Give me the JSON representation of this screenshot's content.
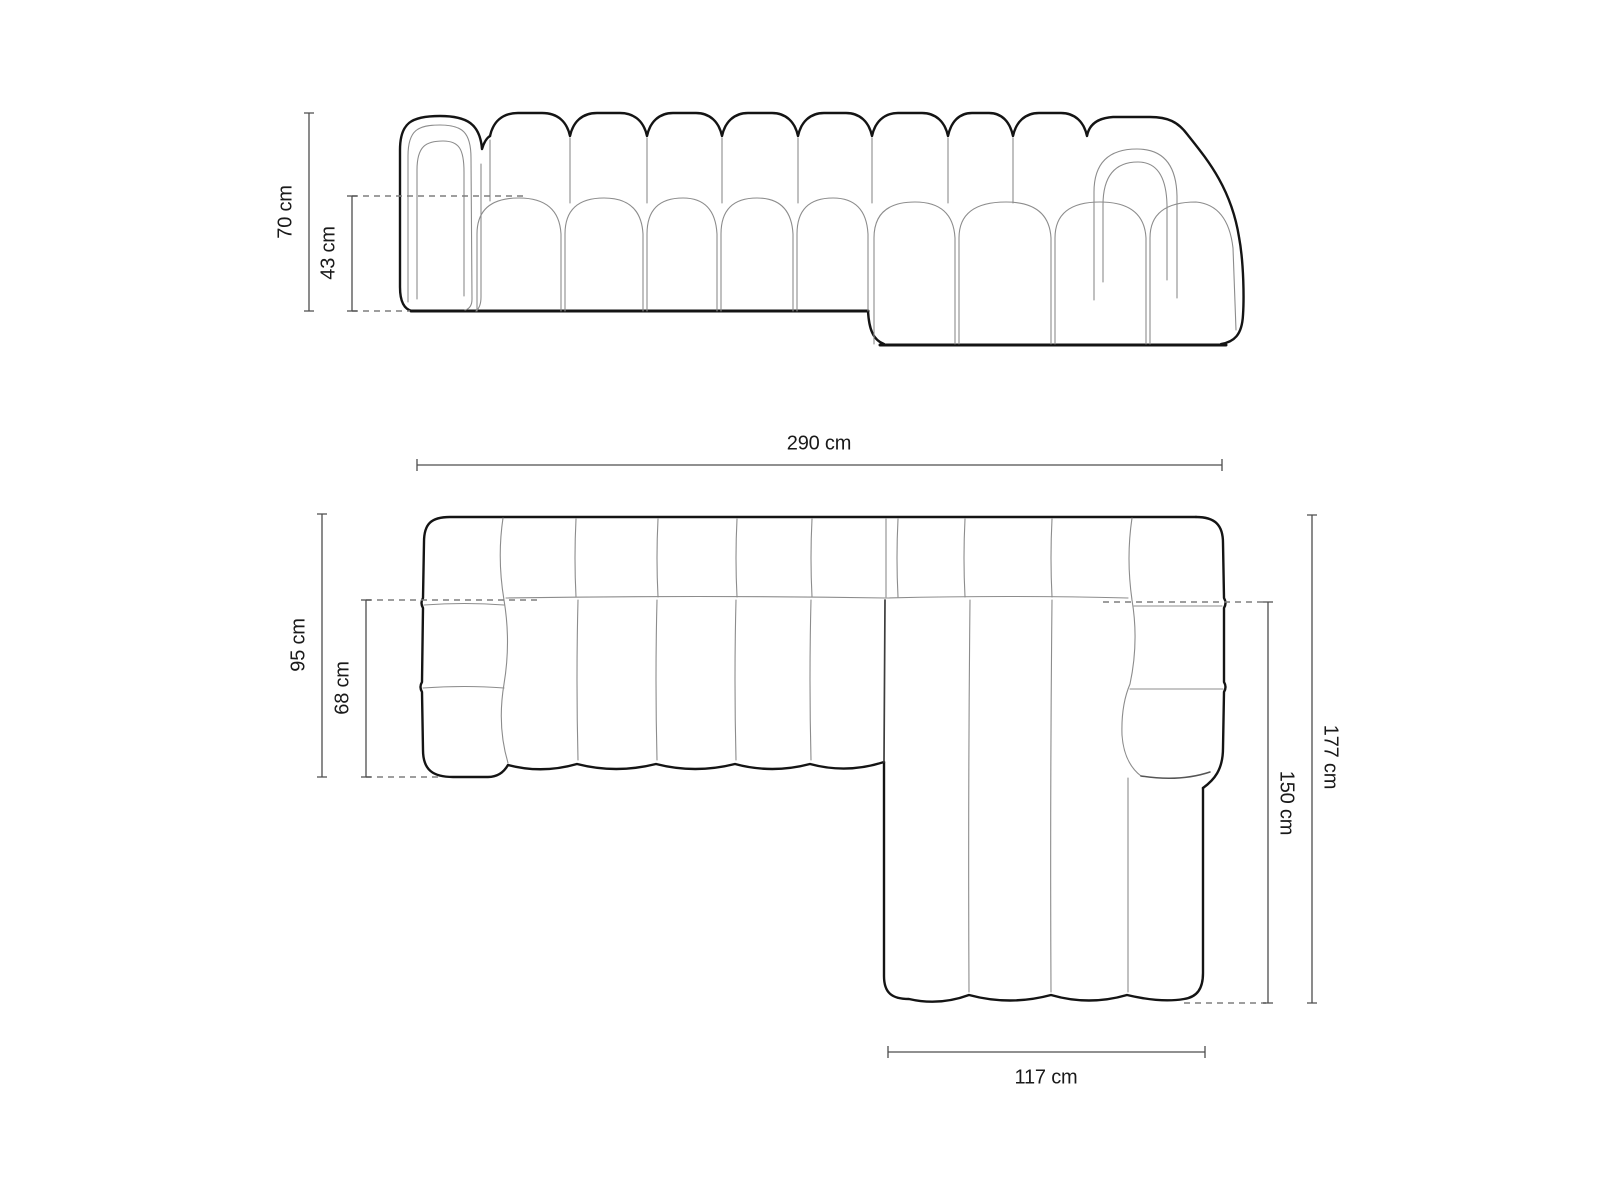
{
  "diagram": {
    "type": "sofa-dimension-drawing",
    "views": [
      "front-elevation",
      "top-plan"
    ]
  },
  "dimensions": {
    "front_height": "70 cm",
    "front_seat_height": "43 cm",
    "total_width": "290 cm",
    "depth": "95 cm",
    "seat_depth": "68 cm",
    "chaise_inner_length": "150 cm",
    "total_depth": "177 cm",
    "chaise_width": "117 cm"
  },
  "unit": "cm",
  "colors": {
    "outline": "#141414",
    "detail": "#8c8c8c",
    "dimension": "#4d4d4d",
    "dashed": "#7e7e7e",
    "text": "#1a1a1a",
    "background": "#ffffff"
  }
}
